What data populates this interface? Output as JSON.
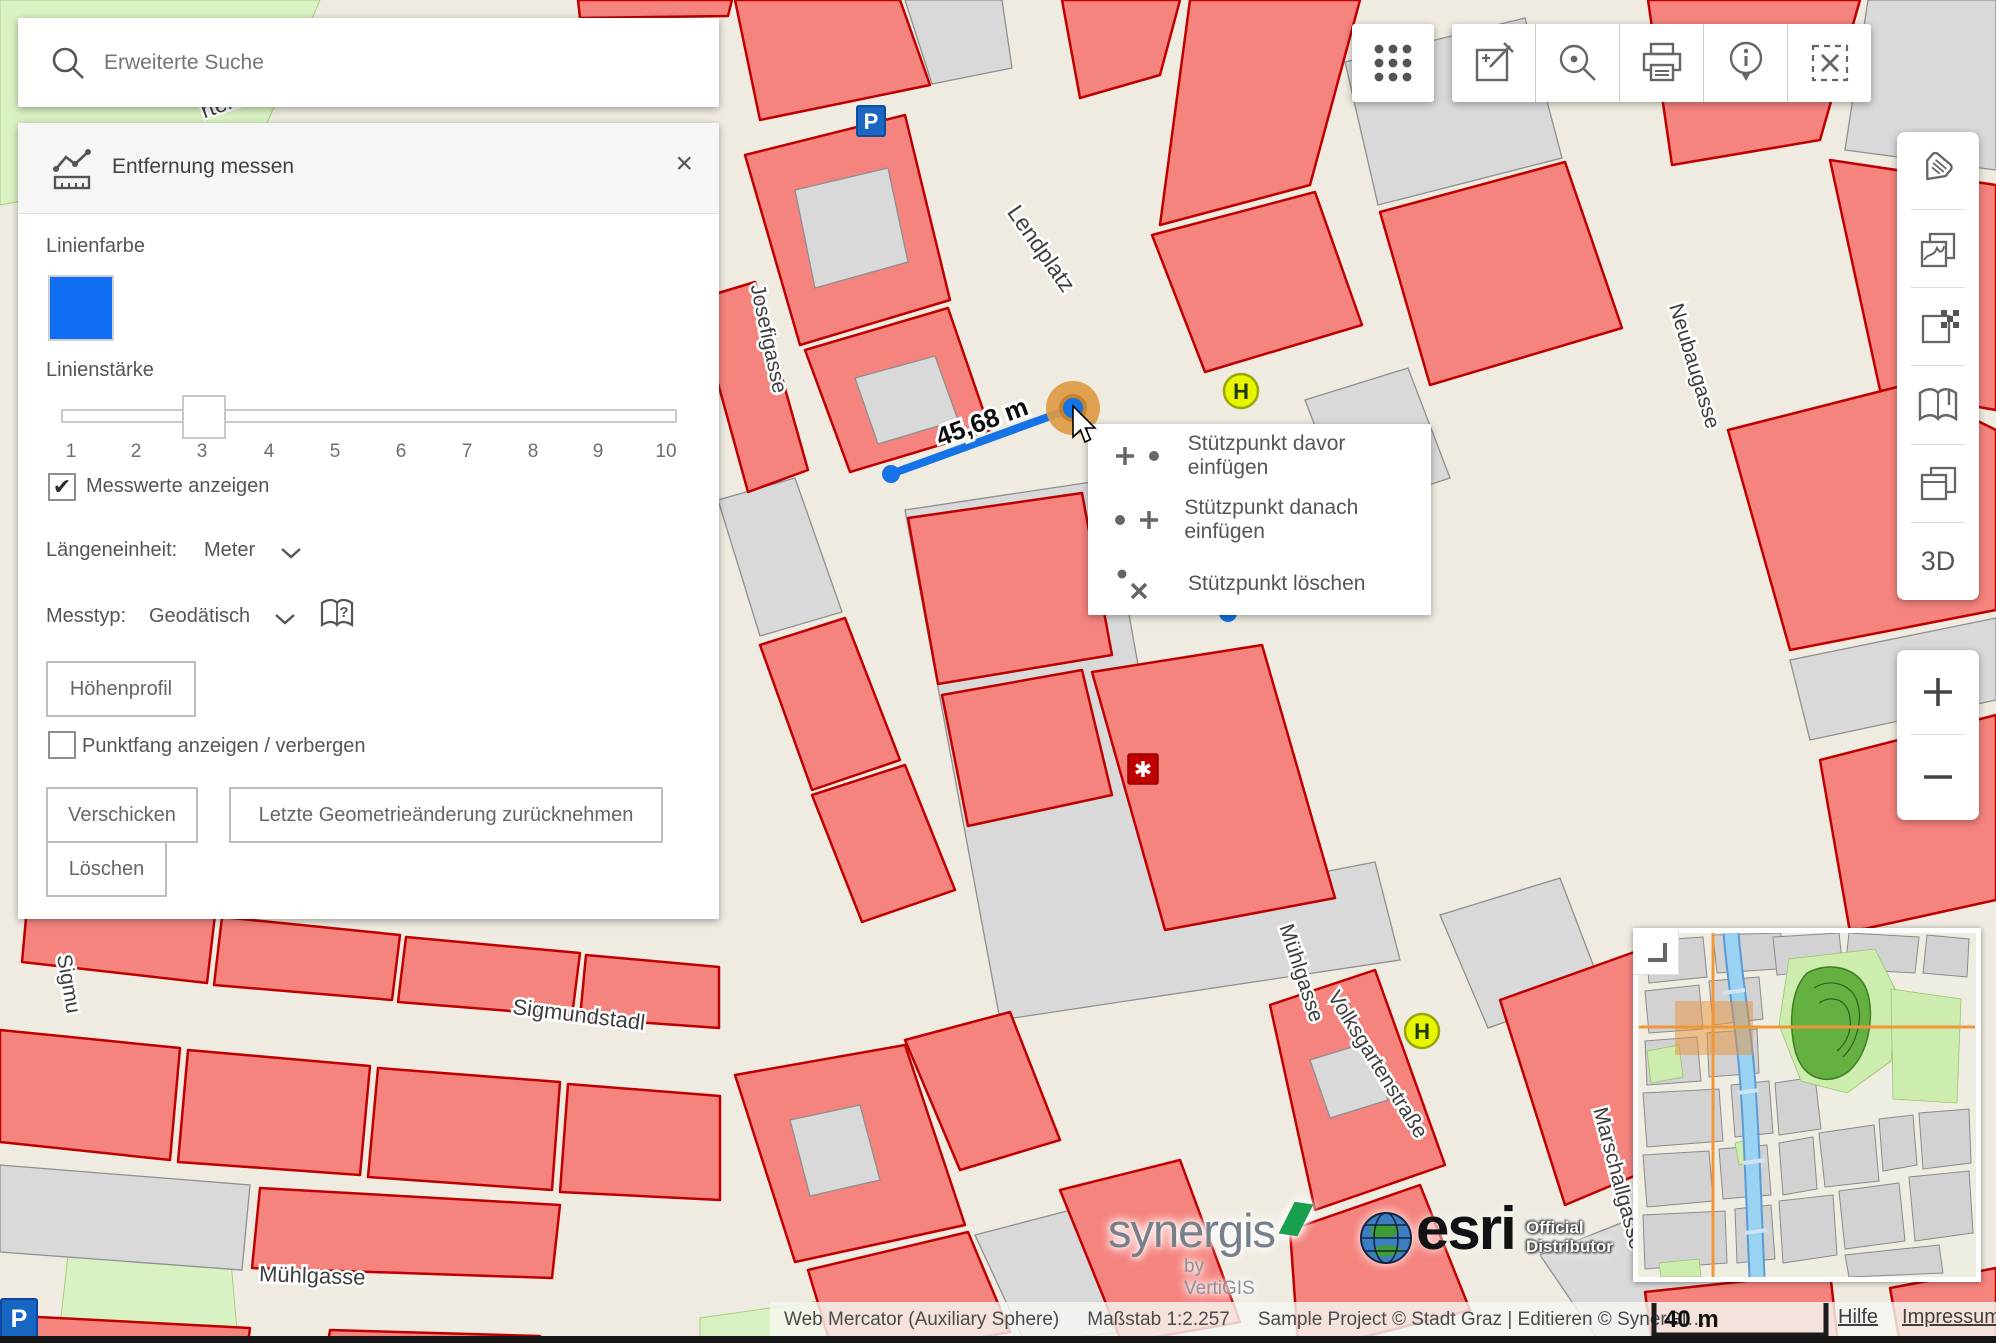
{
  "search": {
    "placeholder": "Erweiterte Suche"
  },
  "measure_panel": {
    "title": "Entfernung messen",
    "close_label": "×",
    "line_color_label": "Linienfarbe",
    "line_color": "#0F6EF2",
    "line_width_label": "Linienstärke",
    "slider": {
      "min": 1,
      "max": 10,
      "value": 3,
      "ticks": [
        "1",
        "2",
        "3",
        "4",
        "5",
        "6",
        "7",
        "8",
        "9",
        "10"
      ]
    },
    "show_values_label": "Messwerte anzeigen",
    "show_values_checked": true,
    "check_glyph": "✔",
    "length_unit_label": "Längeneinheit:",
    "length_unit_value": "Meter",
    "measure_type_label": "Messtyp:",
    "measure_type_value": "Geodätisch",
    "elevation_button": "Höhenprofil",
    "snap_label": "Punktfang anzeigen / verbergen",
    "snap_checked": false,
    "send_button": "Verschicken",
    "undo_button": "Letzte Geometrieänderung zurücknehmen",
    "delete_button": "Löschen"
  },
  "context_menu": {
    "items": [
      {
        "label": "Stützpunkt davor einfügen"
      },
      {
        "label": "Stützpunkt danach einfügen"
      },
      {
        "label": "Stützpunkt löschen"
      }
    ]
  },
  "toolbar_icons": [
    "apps-grid",
    "edit-redline",
    "zoom-point",
    "print",
    "info",
    "clear-selection"
  ],
  "sidebar_icons": [
    "tag",
    "themes",
    "basemap",
    "mapbook",
    "copy-layers"
  ],
  "sidebar_3d_label": "3D",
  "map": {
    "measurement_label": "45,68 m",
    "street_labels": [
      {
        "text": "rten"
      },
      {
        "text": "Lendplatz"
      },
      {
        "text": "Josefigasse"
      },
      {
        "text": "Neubaugasse"
      },
      {
        "text": "Mühlgasse"
      },
      {
        "text": "Volksgartenstraße"
      },
      {
        "text": "Sigmundstadl"
      },
      {
        "text": "Mühlgasse"
      },
      {
        "text": "Sigmu"
      },
      {
        "text": "Marschallgasse"
      }
    ],
    "markers": {
      "parking": "P",
      "transit": "H",
      "hospital": "✱"
    },
    "colors": {
      "building_red": "#F5837E",
      "building_red_border": "#BE0000",
      "block_gray": "#D9D9D9",
      "street_beige": "#EFEBE1",
      "green_area": "#D9F2C3",
      "measure_blue": "#1473E6",
      "vertex_highlight_orange": "#DE9A43"
    }
  },
  "status": {
    "projection": "Web Mercator (Auxiliary Sphere)",
    "scale_text": "Maßstab 1:2.257",
    "copyright": "Sample Project © Stadt Graz | Editieren © SynerGI…"
  },
  "scale_bar_label": "40 m",
  "links": {
    "help": "Hilfe",
    "imprint": "Impressum"
  },
  "logos": {
    "synergis": "synergis",
    "synergis_sub": "by VertiGIS",
    "esri": "esri",
    "esri_sub_line1": "Official",
    "esri_sub_line2": "Distributor"
  }
}
